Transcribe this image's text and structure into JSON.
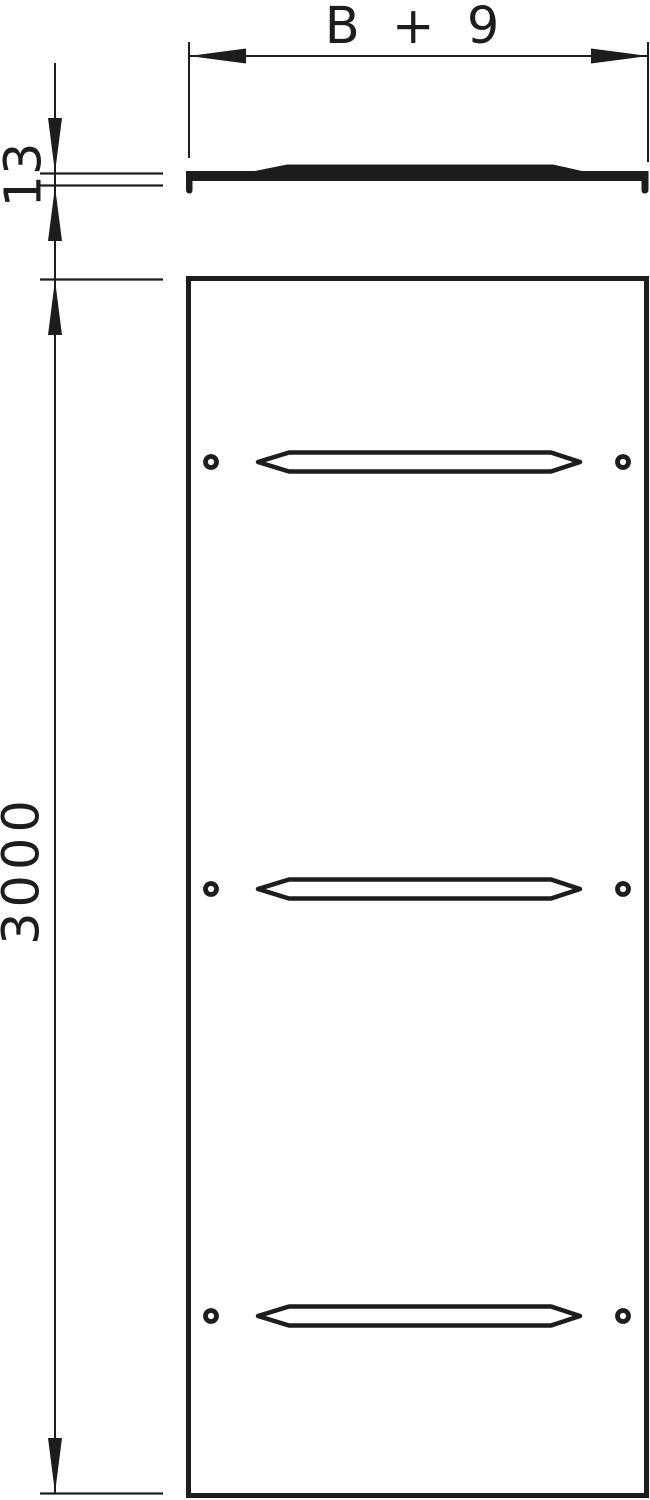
{
  "drawing": {
    "type": "technical-drawing-cable-tray-cover",
    "colors": {
      "line": "#1d1d1b",
      "background": "#ffffff"
    },
    "dimensions": {
      "width": {
        "label": "B + 9"
      },
      "thickness": {
        "label": "13"
      },
      "length": {
        "label": "3000"
      }
    },
    "views": {
      "section": "cover-cross-section",
      "plan": "cover-plan-view"
    }
  }
}
